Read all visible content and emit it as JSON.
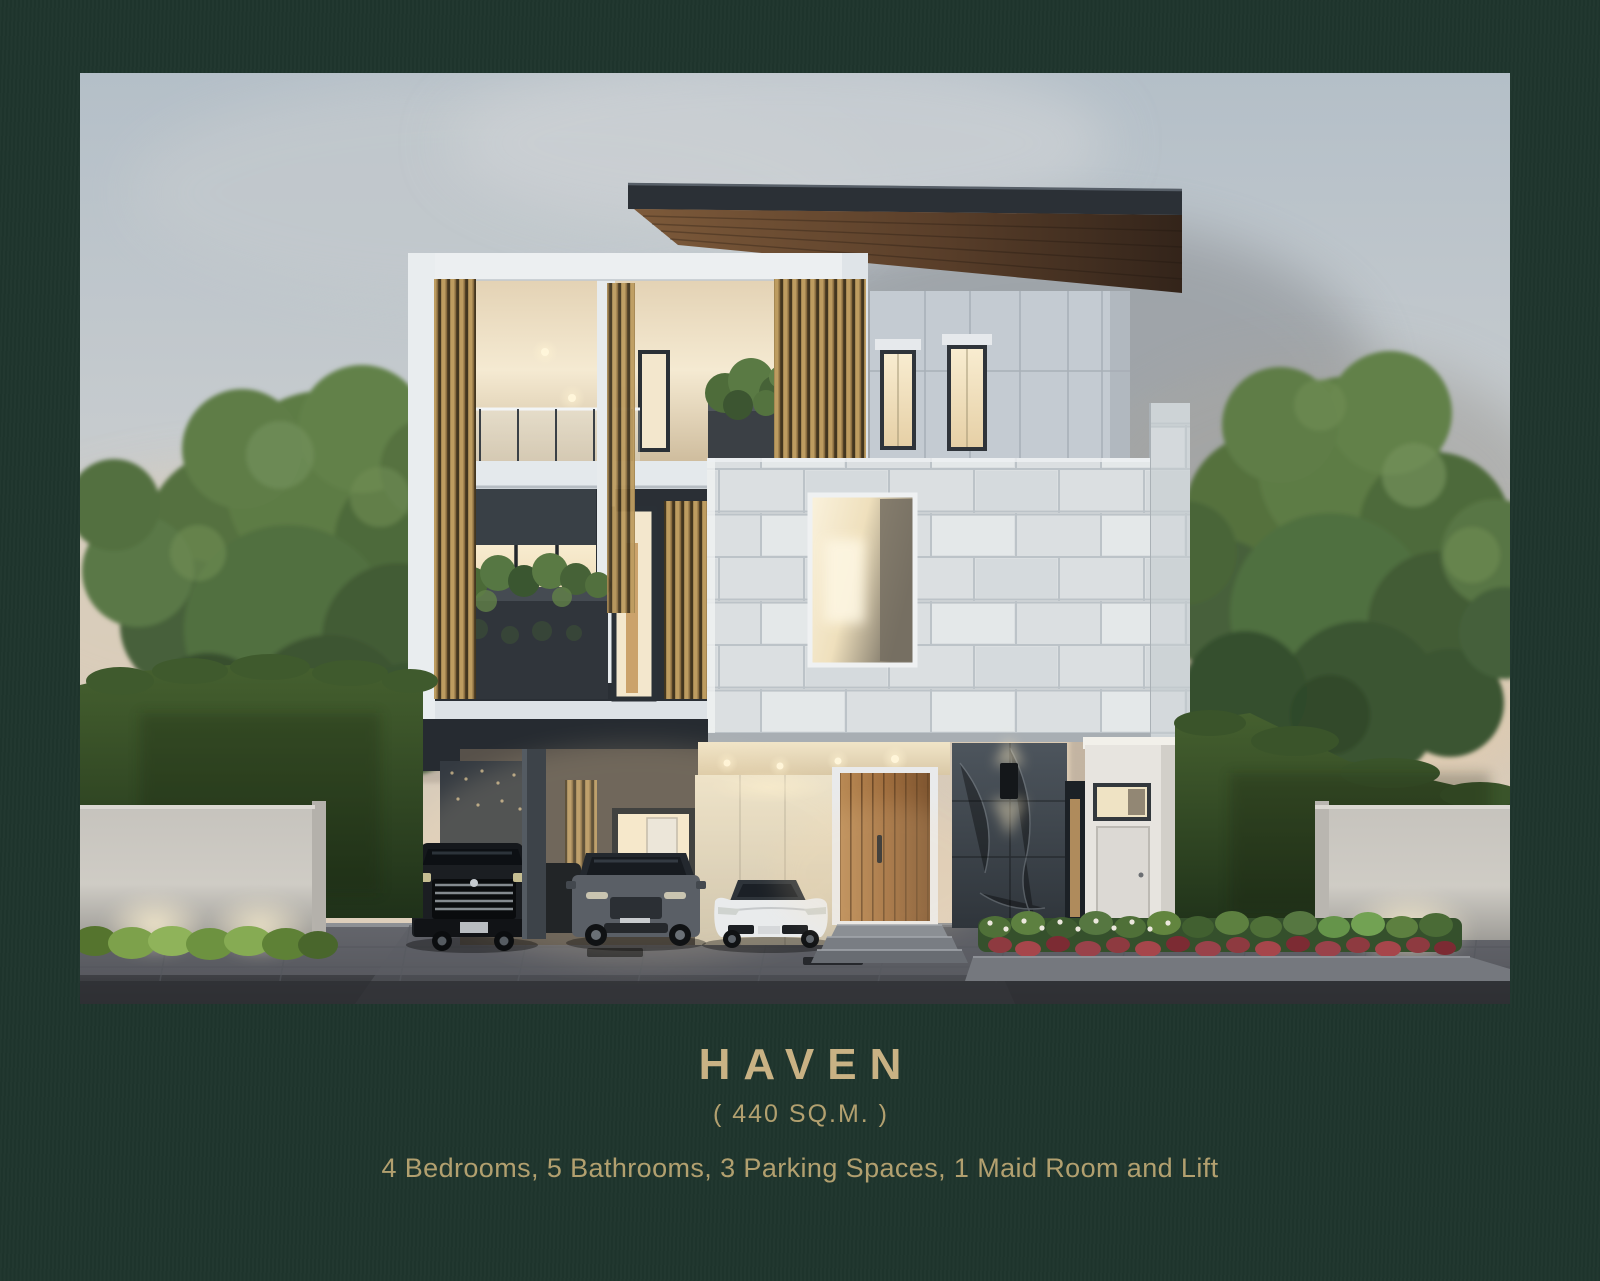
{
  "page": {
    "background_color": "#1f352d",
    "accent_gold": "#c9b284",
    "text_gold": "#b2a06f"
  },
  "caption": {
    "title": "HAVEN",
    "area": "( 440 SQ.M. )",
    "features": "4 Bedrooms, 5 Bathrooms, 3 Parking Spaces, 1 Maid Room and Lift"
  },
  "photo": {
    "alt": "Dusk architectural rendering of the HAVEN type: a modern three-storey detached villa with brass vertical louvres, a white stone-clad volume with a square opening, a dark flat roof with timber soffit, a carport sheltering a black van, a grey SUV and a white sports car, a timber entrance door beside a dark marble wall, flanked by clipped hedges, large trees, up-lit boundary walls and a hazy city skyline"
  }
}
